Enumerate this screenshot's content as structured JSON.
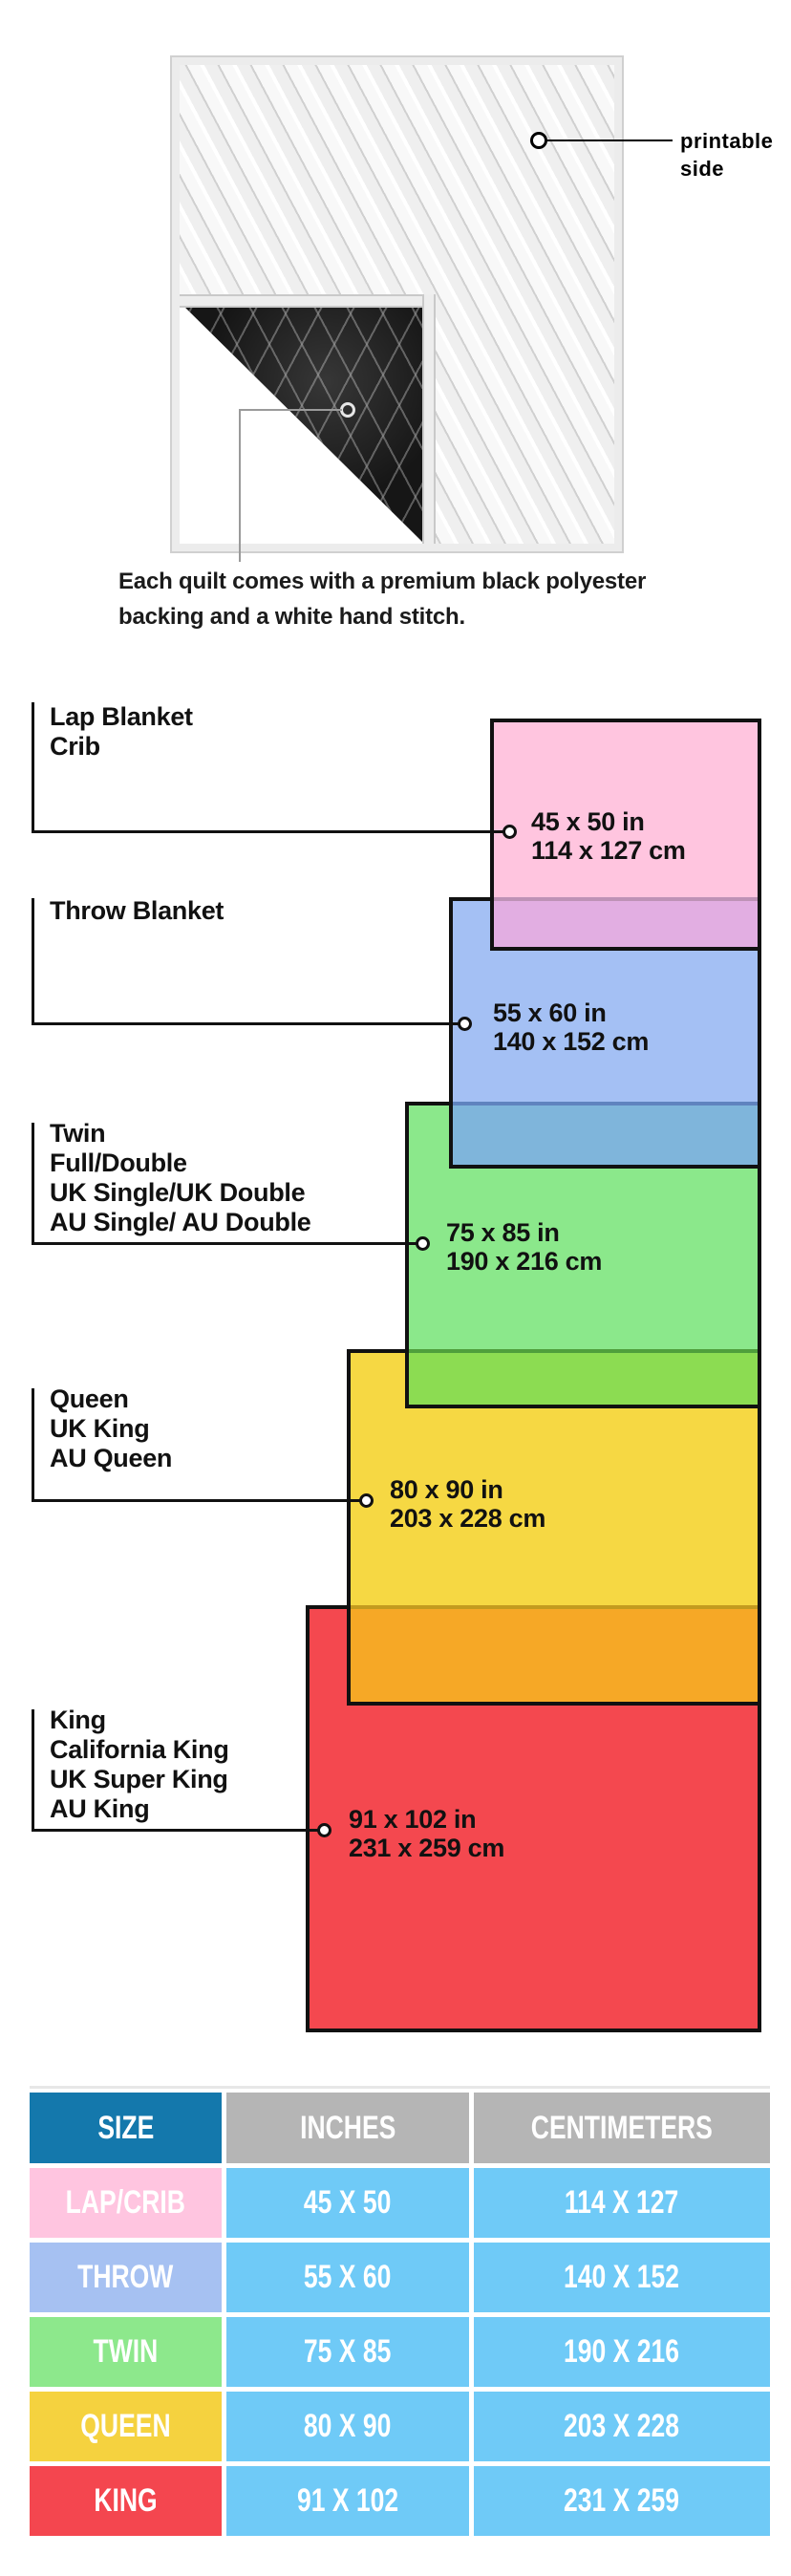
{
  "quilt_section": {
    "printable_label": {
      "line1": "printable",
      "line2": "side"
    },
    "caption": {
      "line1": "Each quilt comes with a premium black polyester",
      "line2": "backing and a white hand stitch."
    }
  },
  "diagram": {
    "groups": [
      {
        "labels": [
          "Lap Blanket",
          "Crib"
        ],
        "inches": "45 x 50 in",
        "cm": "114 x 127 cm",
        "color": "#FFC5DF"
      },
      {
        "labels": [
          "Throw Blanket"
        ],
        "inches": "55 x 60 in",
        "cm": "140 x 152 cm",
        "color": "#A4C0F4"
      },
      {
        "labels": [
          "Twin",
          "Full/Double",
          "UK Single/UK Double",
          "AU Single/ AU Double"
        ],
        "inches": "75 x 85 in",
        "cm": "190 x 216 cm",
        "color": "#8BE88B"
      },
      {
        "labels": [
          "Queen",
          "UK King",
          "AU Queen"
        ],
        "inches": "80 x 90 in",
        "cm": "203 x 228 cm",
        "color": "#F6D843"
      },
      {
        "labels": [
          "King",
          "California King",
          "UK Super King",
          "AU King"
        ],
        "inches": "91 x 102 in",
        "cm": "231 x 259 cm",
        "color": "#F4484F"
      }
    ],
    "overlap_colors": [
      "#E2AEE2",
      "#7FB5DB",
      "#8CDC52",
      "#F6A826"
    ]
  },
  "table": {
    "headers": [
      "SIZE",
      "INCHES",
      "CENTIMETERS"
    ],
    "header_colors": {
      "size": "#1478AC",
      "other": "#B5B5B5",
      "value_cell": "#6FCAF7"
    },
    "rows": [
      {
        "size": "LAP/CRIB",
        "inches": "45 X 50",
        "cm": "114 X 127",
        "color": "#FFC5E0"
      },
      {
        "size": "THROW",
        "inches": "55 X 60",
        "cm": "140 X 152",
        "color": "#A6C1F2"
      },
      {
        "size": "TWIN",
        "inches": "75 X 85",
        "cm": "190 X 216",
        "color": "#8DE88C"
      },
      {
        "size": "QUEEN",
        "inches": "80 X 90",
        "cm": "203 X 228",
        "color": "#F5D23F"
      },
      {
        "size": "KING",
        "inches": "91 X 102",
        "cm": "231 X 259",
        "color": "#F4464F"
      }
    ]
  }
}
